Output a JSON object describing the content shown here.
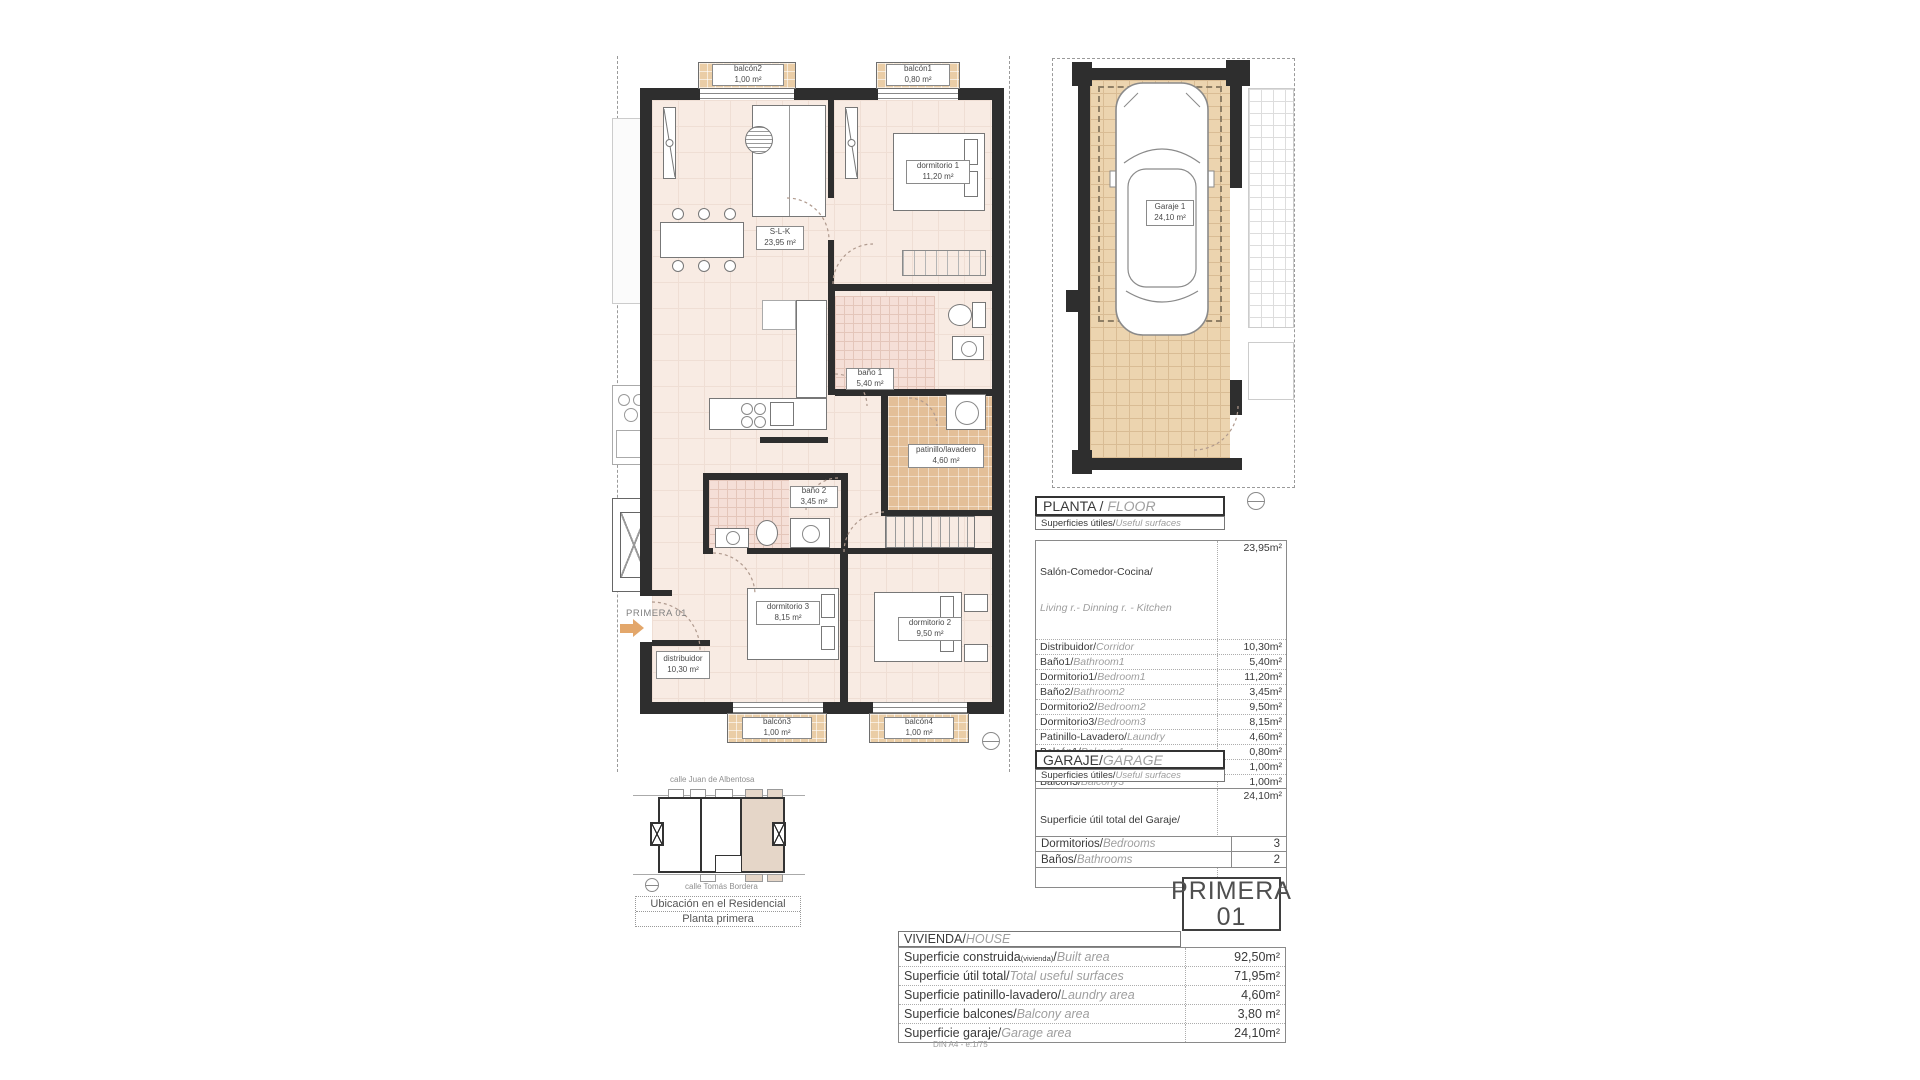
{
  "doc": {
    "footer": "DIN A4 - e:1/75"
  },
  "colors": {
    "floor_fill": "#F8EBE3",
    "balcony_tile": "#EACDA6",
    "garage_tile": "#ECD4AF",
    "bath_tile": "#F5DFD7",
    "patinillo_tile": "#E3BF98",
    "wall": "#2E2E2E",
    "arrow_orange": "#E3A76B",
    "map_highlight": "#E5D6C8",
    "italic_gray": "#9E9E9E"
  },
  "plan": {
    "entry_label": "PRIMERA 01",
    "rooms": {
      "balcon2": {
        "name": "balcón2",
        "area": "1,00 m²"
      },
      "balcon1": {
        "name": "balcón1",
        "area": "0,80 m²"
      },
      "dormitorio1": {
        "name": "dormitorio 1",
        "area": "11,20 m²"
      },
      "slk": {
        "name": "S-L-K",
        "area": "23,95 m²"
      },
      "bano1": {
        "name": "baño 1",
        "area": "5,40 m²"
      },
      "patinillo": {
        "name": "patinillo/lavadero",
        "area": "4,60 m²"
      },
      "bano2": {
        "name": "baño 2",
        "area": "3,45 m²"
      },
      "dormitorio3": {
        "name": "dormitorio 3",
        "area": "8,15 m²"
      },
      "dormitorio2": {
        "name": "dormitorio 2",
        "area": "9,50 m²"
      },
      "distribuidor": {
        "name": "distribuidor",
        "area": "10,30 m²"
      },
      "balcon3": {
        "name": "balcón3",
        "area": "1,00 m²"
      },
      "balcon4": {
        "name": "balcón4",
        "area": "1,00 m²"
      }
    }
  },
  "garage_plan": {
    "name": "Garaje 1",
    "area": "24,10 m²"
  },
  "floor_section": {
    "title": "PLANTA / ",
    "title_en": "FLOOR",
    "subtitle": "Superficies útiles/",
    "subtitle_en": "Useful surfaces",
    "rows": [
      {
        "es": "Salón-Comedor-Cocina/",
        "en": "Living r.- Dinning r. - Kitchen",
        "value": "23,95m²"
      },
      {
        "es": "Distribuidor/",
        "en": "Corridor",
        "value": "10,30m²"
      },
      {
        "es": "Baño1/",
        "en": "Bathroom1",
        "value": "5,40m²"
      },
      {
        "es": "Dormitorio1/",
        "en": "Bedroom1",
        "value": "11,20m²"
      },
      {
        "es": "Baño2/",
        "en": "Bathroom2",
        "value": "3,45m²"
      },
      {
        "es": "Dormitorio2/",
        "en": "Bedroom2",
        "value": "9,50m²"
      },
      {
        "es": "Dormitorio3/",
        "en": "Bedroom3",
        "value": "8,15m²"
      },
      {
        "es": "Patinillo-Lavadero/",
        "en": "Laundry",
        "value": "4,60m²"
      },
      {
        "es": "Balcón1/",
        "en": "Balcony1",
        "value": "0,80m²"
      },
      {
        "es": "Balcón2/",
        "en": "Balcony2",
        "value": "1,00m²"
      },
      {
        "es": "Balcón3/",
        "en": "Balcony3",
        "value": "1,00m²"
      },
      {
        "es": "Balcón4/",
        "en": "Balcony4",
        "value": "1,00m²"
      },
      {
        "es": "Superficie útil total / ",
        "en": "Total useful surface",
        "value": "80,35m²"
      }
    ]
  },
  "garage_section": {
    "title": "GARAJE/",
    "title_en": "GARAGE",
    "subtitle": "Superficies útiles/",
    "subtitle_en": "Useful surfaces",
    "total_es": "Superficie útil total del Garaje/",
    "total_en": "Total useful surface Garage",
    "total_value": "24,10m²"
  },
  "counts": {
    "bedrooms_es": "Dormitorios/",
    "bedrooms_en": "Bedrooms",
    "bedrooms_value": "3",
    "bathrooms_es": "Baños/",
    "bathrooms_en": "Bathrooms",
    "bathrooms_value": "2"
  },
  "unit_badge": {
    "line1": "PRIMERA",
    "line2": "01"
  },
  "house_section": {
    "title": "VIVIENDA/",
    "title_en": "HOUSE",
    "rows": [
      {
        "es": "Superficie construida",
        "small": "(vivienda)",
        "sep": "/",
        "en": "Built area",
        "value": "92,50m²"
      },
      {
        "es": "Superficie útil total/",
        "en": "Total useful surfaces",
        "value": "71,95m²"
      },
      {
        "es": "Superficie patinillo-lavadero/",
        "en": "Laundry area",
        "value": "4,60m²"
      },
      {
        "es": "Superficie balcones/",
        "en": "Balcony area",
        "value": "3,80 m²"
      },
      {
        "es": "Superficie garaje/",
        "en": "Garage area",
        "value": "24,10m²"
      }
    ]
  },
  "location_map": {
    "street_top": "calle Juan de Albentosa",
    "street_bottom": "calle Tomás Bordera",
    "caption_line1": "Ubicación en el Residencial",
    "caption_line2": "Planta primera"
  }
}
